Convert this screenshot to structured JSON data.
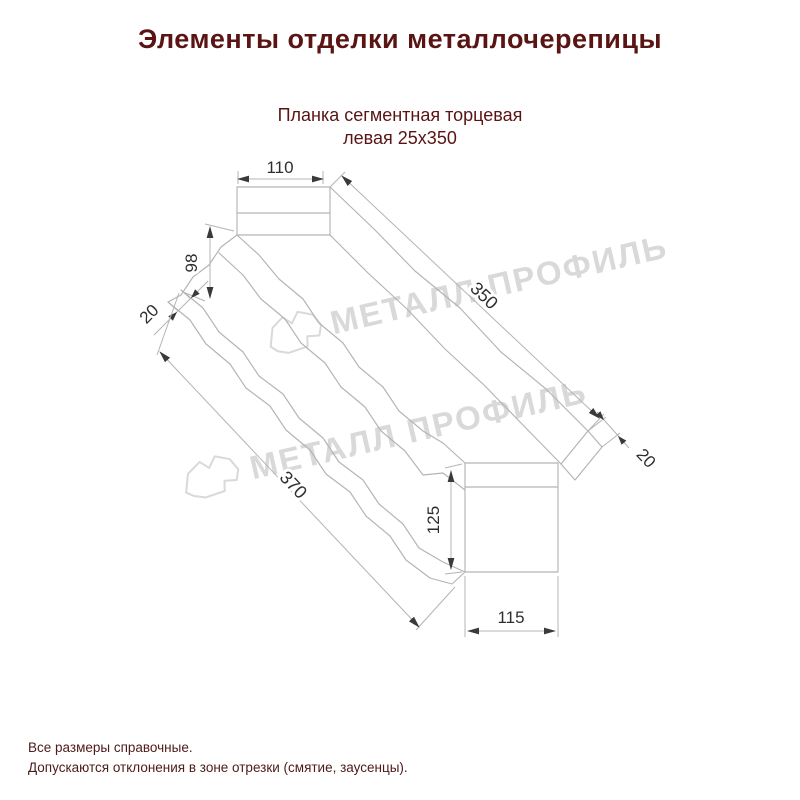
{
  "page": {
    "title": "Элементы отделки металлочерепицы"
  },
  "product": {
    "name_line1": "Планка сегментная торцевая",
    "name_line2": "левая 25х350"
  },
  "drawing": {
    "type": "technical-dimension-drawing",
    "dims": {
      "flange_width": "110",
      "left_height": "98",
      "left_hem": "20",
      "top_length": "350",
      "right_hem": "20",
      "bottom_length": "370",
      "right_height": "125",
      "right_width": "115"
    },
    "watermark_text": "МЕТАЛЛ ПРОФИЛЬ"
  },
  "footer": {
    "note1": "Все размеры справочные.",
    "note2": "Допускаются отклонения в зоне отрезки (смятие, заусенцы)."
  },
  "colors": {
    "heading": "#5a1414",
    "body": "#4e1a1a",
    "line": "#b4b4b4",
    "dimtxt": "#2e2e2e",
    "arrow": "#3a3a3a",
    "wm": "#d9d9d9"
  }
}
